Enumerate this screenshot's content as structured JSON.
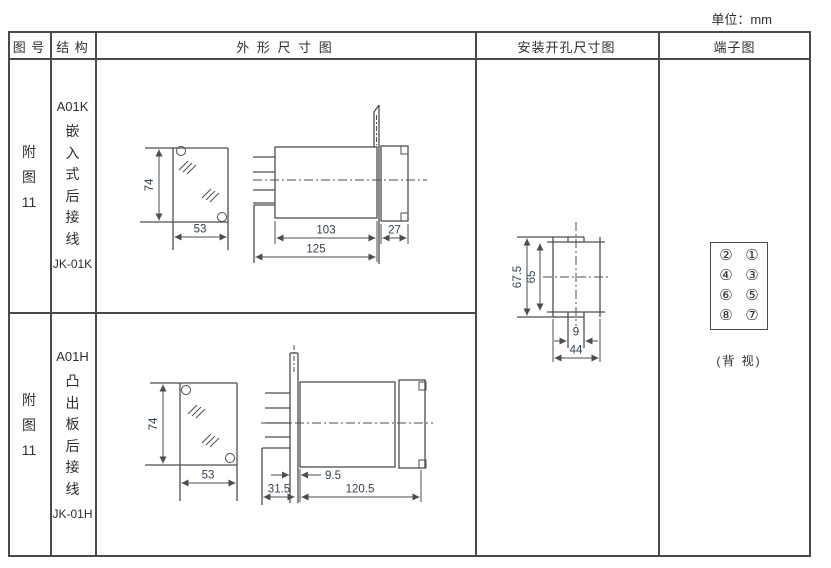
{
  "unit_label": "单位：mm",
  "headers": {
    "fig": "图 号",
    "structure": "结 构",
    "outline": "外 形 尺 寸 图",
    "mounting": "安装开孔尺寸图",
    "terminal": "端子图"
  },
  "rows": [
    {
      "fig_lines": [
        "附",
        "图",
        "11"
      ],
      "model": "A01K",
      "struct_chars": [
        "嵌",
        "入",
        "式",
        "后",
        "接",
        "线"
      ],
      "code": "JK-01K",
      "dims": {
        "h": "74",
        "w": "53",
        "body": "103",
        "bezel": "27",
        "total": "125"
      }
    },
    {
      "fig_lines": [
        "附",
        "图",
        "11"
      ],
      "model": "A01H",
      "struct_chars": [
        "凸",
        "出",
        "板",
        "后",
        "接",
        "线"
      ],
      "code": "JK-01H",
      "dims": {
        "h": "74",
        "w": "53",
        "offset": "9.5",
        "rear": "31.5",
        "total": "120.5"
      }
    }
  ],
  "mounting_dims": {
    "outer_h": "67.5",
    "inner_h": "65",
    "notch_w": "9",
    "width": "44"
  },
  "terminal": {
    "numbers": [
      "②",
      "①",
      "④",
      "③",
      "⑥",
      "⑤",
      "⑧",
      "⑦"
    ],
    "caption": "(背 视)"
  },
  "colors": {
    "line": "#4a4a4a",
    "dim_text": "#33414e"
  }
}
